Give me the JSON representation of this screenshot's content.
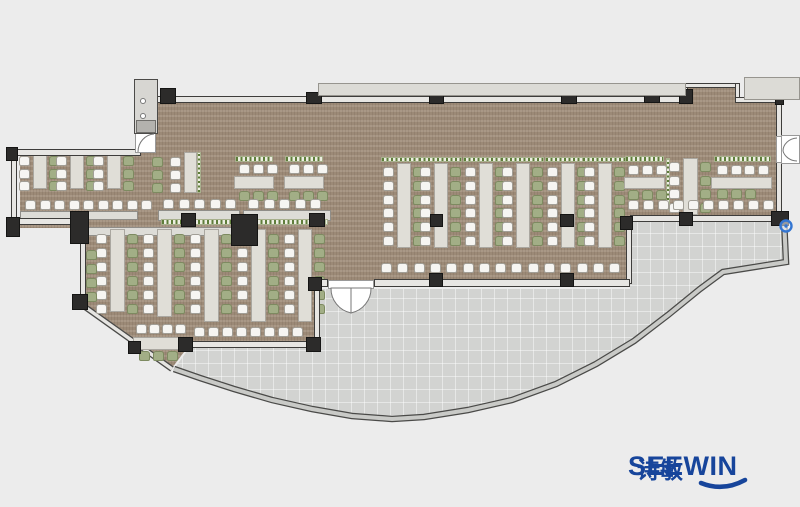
{
  "logo": {
    "brand": "SEEWIN",
    "cjk": "诗敏"
  },
  "palette": {
    "exterior": "#ececec",
    "carpet": "#a4927f",
    "terrace": "#d2d3d1",
    "wall_fill": "#e7e6e3",
    "wall_line": "#3e3d3b",
    "column": "#2c2b2a",
    "slab": "#dcdbd6",
    "table": "#e0ded7",
    "chair_white": "#f6f5f2",
    "chair_green": "#a2ae86",
    "planter_green": "#5e7d3a",
    "logo_blue": "#17459b",
    "marker_blue": "#3476d2"
  },
  "plan": {
    "carpet_polygon": [
      [
        155,
        103
      ],
      [
        684,
        103
      ],
      [
        684,
        85
      ],
      [
        737,
        85
      ],
      [
        737,
        101
      ],
      [
        780,
        101
      ],
      [
        780,
        215
      ],
      [
        631,
        215
      ],
      [
        631,
        283
      ],
      [
        318,
        283
      ],
      [
        318,
        344
      ],
      [
        190,
        344
      ],
      [
        172,
        368
      ],
      [
        85,
        308
      ],
      [
        85,
        228
      ],
      [
        20,
        228
      ],
      [
        20,
        153
      ],
      [
        155,
        153
      ]
    ],
    "terrace_polygon": [
      [
        190,
        347
      ],
      [
        316,
        347
      ],
      [
        316,
        289
      ],
      [
        630,
        289
      ],
      [
        630,
        219
      ],
      [
        784,
        219
      ],
      [
        786,
        262
      ],
      [
        723,
        272
      ],
      [
        700,
        289
      ],
      [
        668,
        315
      ],
      [
        634,
        341
      ],
      [
        596,
        364
      ],
      [
        556,
        384
      ],
      [
        512,
        400
      ],
      [
        468,
        410
      ],
      [
        424,
        417
      ],
      [
        392,
        419
      ],
      [
        352,
        416
      ],
      [
        312,
        409
      ],
      [
        272,
        400
      ],
      [
        234,
        389
      ],
      [
        200,
        378
      ],
      [
        174,
        369
      ]
    ],
    "walls": [
      [
        153,
        96,
        534,
        7
      ],
      [
        683,
        83,
        5,
        18
      ],
      [
        683,
        83,
        57,
        5
      ],
      [
        735,
        83,
        5,
        17
      ],
      [
        735,
        97,
        47,
        6
      ],
      [
        776,
        100,
        6,
        38
      ],
      [
        776,
        162,
        6,
        52
      ],
      [
        630,
        215,
        152,
        7
      ],
      [
        626,
        220,
        6,
        64
      ],
      [
        374,
        279,
        256,
        8
      ],
      [
        318,
        279,
        10,
        8
      ],
      [
        314,
        285,
        6,
        58
      ],
      [
        186,
        341,
        130,
        7
      ],
      [
        80,
        238,
        6,
        72
      ],
      [
        15,
        218,
        62,
        7
      ],
      [
        11,
        151,
        6,
        74
      ],
      [
        11,
        149,
        130,
        7
      ],
      [
        152,
        101,
        4,
        33
      ],
      [
        437,
        83,
        2,
        13
      ]
    ],
    "counters": [
      [
        20,
        211,
        118,
        9
      ],
      [
        88,
        227,
        149,
        9
      ],
      [
        158,
        210,
        82,
        11
      ],
      [
        243,
        210,
        88,
        11
      ]
    ],
    "planters": [
      [
        161,
        219,
        76,
        6,
        "h"
      ],
      [
        246,
        219,
        82,
        6,
        "h"
      ]
    ],
    "columns": [
      [
        160,
        88,
        16,
        16
      ],
      [
        306,
        92,
        16,
        12
      ],
      [
        429,
        94,
        15,
        10
      ],
      [
        561,
        92,
        16,
        12
      ],
      [
        644,
        90,
        16,
        13
      ],
      [
        679,
        89,
        14,
        15
      ],
      [
        775,
        95,
        9,
        10
      ],
      [
        771,
        211,
        18,
        15
      ],
      [
        679,
        212,
        14,
        14
      ],
      [
        620,
        216,
        13,
        14
      ],
      [
        560,
        273,
        14,
        14
      ],
      [
        429,
        273,
        14,
        14
      ],
      [
        308,
        277,
        14,
        14
      ],
      [
        306,
        337,
        15,
        15
      ],
      [
        178,
        337,
        15,
        15
      ],
      [
        128,
        341,
        13,
        13
      ],
      [
        72,
        294,
        16,
        16
      ],
      [
        70,
        211,
        19,
        33
      ],
      [
        231,
        214,
        27,
        32
      ],
      [
        6,
        217,
        14,
        20
      ],
      [
        6,
        147,
        12,
        14
      ],
      [
        181,
        213,
        15,
        14
      ],
      [
        309,
        213,
        16,
        14
      ],
      [
        430,
        214,
        13,
        13
      ],
      [
        560,
        214,
        14,
        13
      ]
    ],
    "slabs": [
      [
        318,
        83,
        368,
        13
      ],
      [
        744,
        77,
        56,
        23
      ]
    ],
    "shaft": {
      "body": [
        134,
        79,
        24,
        55
      ],
      "block": [
        136,
        120,
        20,
        13
      ]
    },
    "door_rects": [
      [
        328,
        280,
        46,
        9
      ],
      [
        781,
        135,
        19,
        29
      ],
      [
        776,
        136,
        6,
        27
      ],
      [
        135,
        132,
        21,
        21
      ]
    ],
    "furniture": {
      "strips": [
        {
          "t": [
            33,
            153,
            14,
            36
          ],
          "lc": "white",
          "rc": "green",
          "n": 3,
          "cy": 156,
          "step": 12.5
        },
        {
          "t": [
            70,
            153,
            14,
            36
          ],
          "lc": "white",
          "rc": "green",
          "n": 3,
          "cy": 156,
          "step": 12.5
        },
        {
          "t": [
            107,
            153,
            14,
            36
          ],
          "lc": "white",
          "rc": "green",
          "n": 3,
          "cy": 156,
          "step": 12.5
        },
        {
          "t": [
            184,
            152,
            13,
            41
          ],
          "lc": "white",
          "rc": null,
          "n": 3,
          "cy": 157,
          "step": 13,
          "p": [
            197,
            152,
            4,
            41,
            "v"
          ]
        },
        {
          "t": [
            110,
            229,
            15,
            83
          ],
          "lc": "white",
          "rc": "green",
          "n": 6,
          "cy": 234,
          "step": 14
        },
        {
          "t": [
            157,
            229,
            15,
            88
          ],
          "lc": "white",
          "rc": "green",
          "n": 6,
          "cy": 234,
          "step": 14
        },
        {
          "t": [
            204,
            229,
            15,
            93
          ],
          "lc": "white",
          "rc": "green",
          "n": 6,
          "cy": 234,
          "step": 14
        },
        {
          "t": [
            251,
            229,
            15,
            93
          ],
          "lc": "white",
          "rc": "green",
          "n": 6,
          "cy": 234,
          "step": 14
        },
        {
          "t": [
            298,
            229,
            14,
            93
          ],
          "lc": "white",
          "rc": "green",
          "n": 6,
          "cy": 234,
          "step": 14
        },
        {
          "t": [
            397,
            163,
            14,
            85
          ],
          "lc": "white",
          "rc": "green",
          "n": 6,
          "cy": 167,
          "step": 13.8,
          "p": [
            381,
            157,
            44,
            5,
            "h"
          ]
        },
        {
          "t": [
            434,
            163,
            14,
            85
          ],
          "lc": "white",
          "rc": "green",
          "n": 6,
          "cy": 167,
          "step": 13.8,
          "p": [
            418,
            157,
            44,
            5,
            "h"
          ]
        },
        {
          "t": [
            479,
            163,
            14,
            85
          ],
          "lc": "white",
          "rc": "green",
          "n": 6,
          "cy": 167,
          "step": 13.8,
          "p": [
            463,
            157,
            44,
            5,
            "h"
          ]
        },
        {
          "t": [
            516,
            163,
            14,
            85
          ],
          "lc": "white",
          "rc": "green",
          "n": 6,
          "cy": 167,
          "step": 13.8,
          "p": [
            500,
            157,
            44,
            5,
            "h"
          ]
        },
        {
          "t": [
            561,
            163,
            14,
            85
          ],
          "lc": "white",
          "rc": "green",
          "n": 6,
          "cy": 167,
          "step": 13.8,
          "p": [
            545,
            157,
            44,
            5,
            "h"
          ]
        },
        {
          "t": [
            598,
            163,
            14,
            85
          ],
          "lc": "white",
          "rc": "green",
          "n": 6,
          "cy": 167,
          "step": 13.8,
          "p": [
            582,
            157,
            44,
            5,
            "h"
          ]
        },
        {
          "t": [
            683,
            158,
            15,
            57
          ],
          "lc": "white",
          "rc": "green",
          "n": 4,
          "cy": 162,
          "step": 13.5,
          "p": [
            666,
            158,
            4,
            52,
            "v"
          ]
        }
      ],
      "chair_cols": [
        {
          "x": 152,
          "y": 157,
          "n": 3,
          "c": "green",
          "step": 13
        },
        {
          "x": 86,
          "y": 250,
          "n": 4,
          "c": "green",
          "step": 14
        }
      ],
      "hgroups": [
        {
          "p": [
            235,
            156,
            38,
            6
          ],
          "top": {
            "x": 239,
            "y": 164,
            "n": 3,
            "step": 14,
            "c": "white"
          },
          "t": [
            234,
            176,
            40,
            13
          ],
          "bot": {
            "x": 239,
            "y": 191,
            "n": 3,
            "step": 14,
            "c": "green"
          }
        },
        {
          "p": [
            285,
            156,
            38,
            6
          ],
          "top": {
            "x": 289,
            "y": 164,
            "n": 3,
            "step": 14,
            "c": "white"
          },
          "t": [
            284,
            176,
            40,
            13
          ],
          "bot": {
            "x": 289,
            "y": 191,
            "n": 3,
            "step": 14,
            "c": "green"
          }
        },
        {
          "p": [
            625,
            156,
            39,
            6
          ],
          "top": {
            "x": 628,
            "y": 165,
            "n": 3,
            "step": 14,
            "c": "white"
          },
          "t": [
            624,
            177,
            41,
            12
          ],
          "bot": {
            "x": 628,
            "y": 190,
            "n": 3,
            "step": 14,
            "c": "green"
          }
        },
        {
          "p": [
            714,
            156,
            57,
            6
          ],
          "top": {
            "x": 717,
            "y": 165,
            "n": 4,
            "step": 13.5,
            "c": "white"
          },
          "t": [
            711,
            177,
            61,
            12
          ],
          "bot": {
            "x": 717,
            "y": 189,
            "n": 3,
            "step": 14,
            "c": "green"
          }
        },
        {
          "top": {
            "x": 136,
            "y": 324,
            "n": 4,
            "step": 13,
            "c": "white"
          },
          "t": [
            133,
            337,
            55,
            13
          ],
          "bot": {
            "x": 139,
            "y": 351,
            "n": 3,
            "step": 14,
            "c": "green"
          }
        }
      ],
      "chair_rows": [
        {
          "x": 25,
          "y": 200,
          "n": 9,
          "step": 14.5,
          "c": "white"
        },
        {
          "x": 163,
          "y": 199,
          "n": 5,
          "step": 15.5,
          "c": "white"
        },
        {
          "x": 248,
          "y": 199,
          "n": 5,
          "step": 15.5,
          "c": "white"
        },
        {
          "x": 381,
          "y": 263,
          "n": 15,
          "step": 16.3,
          "c": "white"
        },
        {
          "x": 628,
          "y": 200,
          "n": 10,
          "step": 15,
          "c": "white"
        },
        {
          "x": 194,
          "y": 327,
          "n": 8,
          "step": 14,
          "c": "white"
        }
      ]
    },
    "svg_under": [
      {
        "d": "M85,307 L172,369",
        "stroke": "#4a4a48",
        "sw": 6
      },
      {
        "d": "M85,307 L172,369",
        "stroke": "#e6e5e2",
        "sw": 3.5
      },
      {
        "d": "M784,219 L786,262 L723,272 L700,289 L668,315 L634,341 L596,364 L556,384 L512,400 L468,410 L424,417 L392,419 L352,416 L312,409 L272,400 L234,389 L200,378 L174,369",
        "stroke": "#4a4a48",
        "sw": 6.5
      },
      {
        "d": "M784,219 L786,262 L723,272 L700,289 L668,315 L634,341 L596,364 L556,384 L512,400 L468,410 L424,417 L392,419 L352,416 L312,409 L272,400 L234,389 L200,378 L174,369",
        "stroke": "#c9cac7",
        "sw": 4
      }
    ],
    "svg_over": [
      {
        "d": "M331,288 A25,25 0 0 0 351,313 L351,288 Z",
        "fill": "#ffffff",
        "stroke": "#777777",
        "sw": 1
      },
      {
        "d": "M371,288 A25,25 0 0 1 351,313 L351,288 Z",
        "fill": "#ffffff",
        "stroke": "#777777",
        "sw": 1
      },
      {
        "d": "M797,138 A15,13 0 0 0 783,151",
        "stroke": "#777777",
        "sw": 1
      },
      {
        "d": "M797,161 A15,13 0 0 1 783,151",
        "stroke": "#777777",
        "sw": 1
      },
      {
        "d": "M154,134 A17,18 0 0 0 138,152",
        "stroke": "#777777",
        "sw": 1
      },
      {
        "circle": [
          143,
          101,
          2.5
        ],
        "fill": "#ffffff",
        "stroke": "#777777",
        "sw": 1
      },
      {
        "circle": [
          143,
          116,
          2.5
        ],
        "fill": "#ffffff",
        "stroke": "#777777",
        "sw": 1
      },
      {
        "circle": [
          786,
          226,
          5.5
        ],
        "fill": "rgba(240,245,255,0.55)",
        "stroke": "#3476d2",
        "sw": 2.4
      },
      {
        "circle": [
          786,
          226,
          1.7
        ],
        "fill": "#3476d2"
      },
      {
        "d": "M701,483 Q723,492 745,480",
        "stroke": "#17459b",
        "sw": 4.6,
        "cap": "round"
      }
    ]
  }
}
